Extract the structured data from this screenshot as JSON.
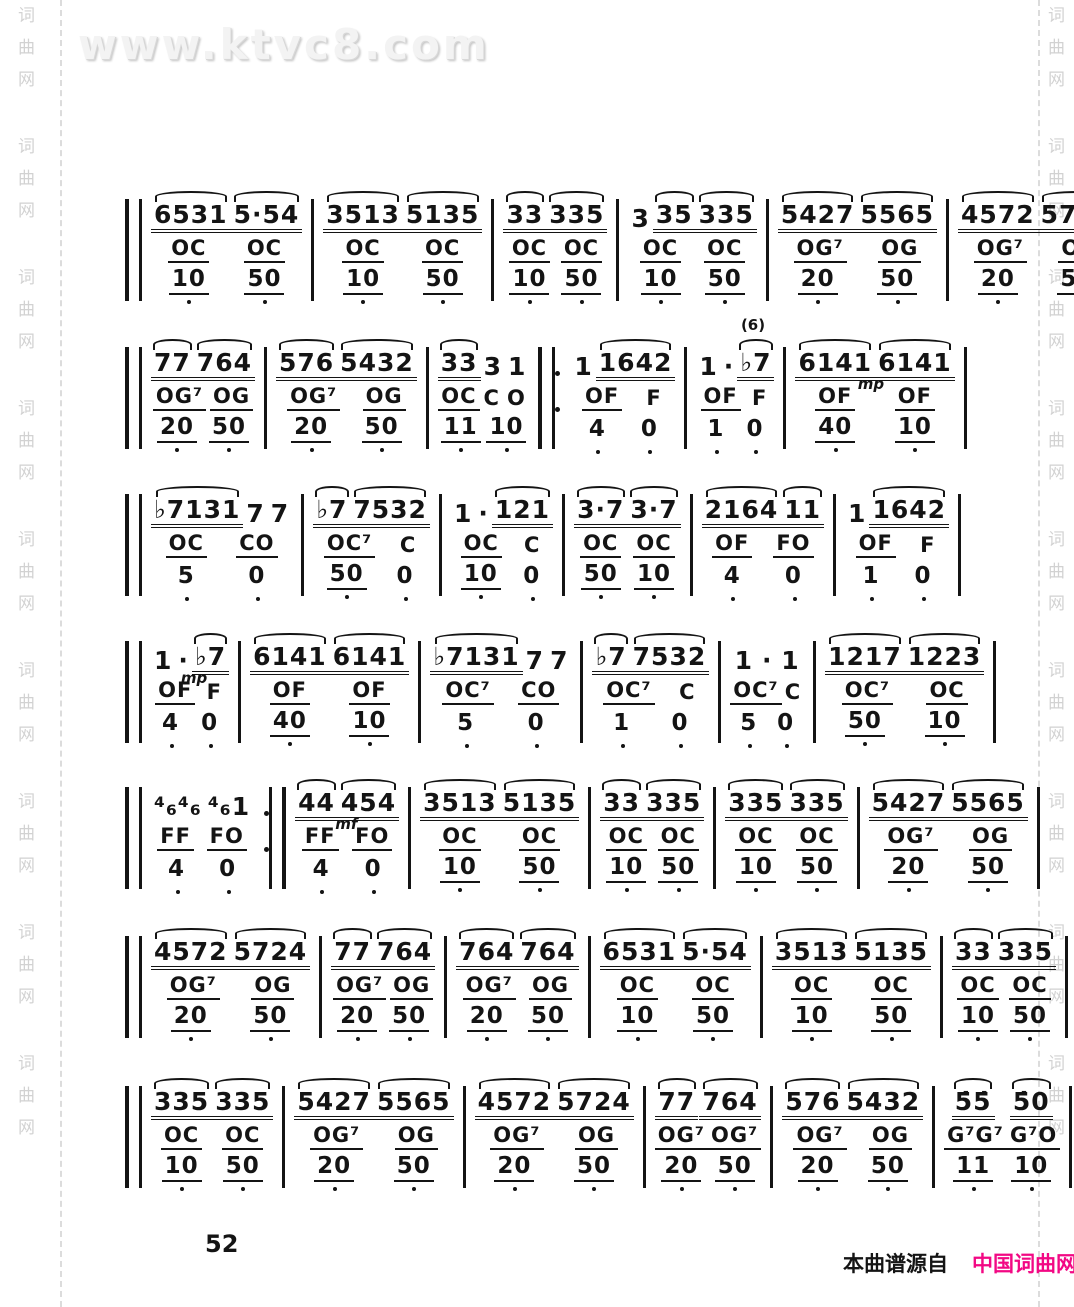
{
  "watermark": {
    "site": "www.ktvc8.com",
    "side_text": "词曲网"
  },
  "page_number": "52",
  "footer": {
    "prefix": "本曲谱源自",
    "site": "中国词曲网",
    "site_color": "#f20884"
  },
  "score": {
    "rows": [
      {
        "start_bar": "double",
        "end_bar": "single",
        "measures": [
          {
            "melody": "6531 5·54",
            "chord": "OC OC",
            "bass": "10 50"
          },
          {
            "melody": "3513 5135",
            "chord": "OC OC",
            "bass": "10 50"
          },
          {
            "melody": "33 335",
            "chord": "OC OC",
            "bass": "10 50"
          },
          {
            "melody": "3 35 335",
            "chord": "OC OC",
            "bass": "10 50"
          },
          {
            "melody": "5427 5565",
            "chord": "OG⁷ OG",
            "bass": "20 50"
          },
          {
            "melody": "4572 5724",
            "chord": "OG⁷ OG",
            "bass": "20 50"
          }
        ]
      },
      {
        "start_bar": "double",
        "end_bar": "single",
        "measures": [
          {
            "melody": "77 764",
            "chord": "OG⁷ OG",
            "bass": "20 50"
          },
          {
            "melody": "576 5432",
            "chord": "OG⁷ OG",
            "bass": "20 50"
          },
          {
            "melody": "33 3 1",
            "chord": "OC C O",
            "bass": "11 10"
          },
          {
            "melody": "1 1642",
            "chord": "OF F",
            "bass": "4 0",
            "left_bar": "repeat-begin"
          },
          {
            "melody": "1 · ♭7",
            "chord": "OF F",
            "bass": "1 0",
            "note": "(6)"
          },
          {
            "melody": "6141 6141",
            "chord": "OF OF",
            "bass": "40 10",
            "note": "mp"
          }
        ]
      },
      {
        "start_bar": "double",
        "end_bar": "single",
        "measures": [
          {
            "melody": "♭7131 7 7",
            "chord": "OC CO",
            "bass": "5 0"
          },
          {
            "melody": "♭7 7532",
            "chord": "OC⁷ C",
            "bass": "50 0"
          },
          {
            "melody": "1 · 121",
            "chord": "OC C",
            "bass": "10 0"
          },
          {
            "melody": "3·7 3·7",
            "chord": "OC OC",
            "bass": "50 10"
          },
          {
            "melody": "2164 11",
            "chord": "OF FO",
            "bass": "4 0"
          },
          {
            "melody": "1 1642",
            "chord": "OF F",
            "bass": "1 0"
          }
        ]
      },
      {
        "start_bar": "double",
        "end_bar": "single",
        "measures": [
          {
            "melody": "1 · ♭7",
            "chord": "OF F",
            "bass": "4 0",
            "note": "mp"
          },
          {
            "melody": "6141 6141",
            "chord": "OF OF",
            "bass": "40 10"
          },
          {
            "melody": "♭7131 7 7",
            "chord": "OC⁷ CO",
            "bass": "5 0"
          },
          {
            "melody": "♭7 7532",
            "chord": "OC⁷ C",
            "bass": "1 0"
          },
          {
            "melody": "1 · 1",
            "chord": "OC⁷ C",
            "bass": "5 0"
          },
          {
            "melody": "1217 1223",
            "chord": "OC⁷ OC",
            "bass": "50 10"
          }
        ]
      },
      {
        "start_bar": "double",
        "end_bar": "single",
        "measures": [
          {
            "melody": "⁴₆⁴₆ ⁴₆1",
            "chord": "FF FO",
            "bass": "4 0"
          },
          {
            "melody": "44 454",
            "chord": "FF FO",
            "bass": "4 0",
            "left_bar": "repeat-end",
            "note": "mf"
          },
          {
            "melody": "3513 5135",
            "chord": "OC OC",
            "bass": "10 50"
          },
          {
            "melody": "33 335",
            "chord": "OC OC",
            "bass": "10 50"
          },
          {
            "melody": "335 335",
            "chord": "OC OC",
            "bass": "10 50"
          },
          {
            "melody": "5427 5565",
            "chord": "OG⁷ OG",
            "bass": "20 50"
          }
        ]
      },
      {
        "start_bar": "double",
        "end_bar": "single",
        "measures": [
          {
            "melody": "4572 5724",
            "chord": "OG⁷ OG",
            "bass": "20 50"
          },
          {
            "melody": "77 764",
            "chord": "OG⁷ OG",
            "bass": "20 50"
          },
          {
            "melody": "764 764",
            "chord": "OG⁷ OG",
            "bass": "20 50"
          },
          {
            "melody": "6531 5·54",
            "chord": "OC OC",
            "bass": "10 50"
          },
          {
            "melody": "3513 5135",
            "chord": "OC OC",
            "bass": "10 50"
          },
          {
            "melody": "33 335",
            "chord": "OC OC",
            "bass": "10 50"
          }
        ]
      },
      {
        "start_bar": "double",
        "end_bar": "final",
        "measures": [
          {
            "melody": "335 335",
            "chord": "OC OC",
            "bass": "10 50"
          },
          {
            "melody": "5427 5565",
            "chord": "OG⁷ OG",
            "bass": "20 50"
          },
          {
            "melody": "4572 5724",
            "chord": "OG⁷ OG",
            "bass": "20 50"
          },
          {
            "melody": "77 764",
            "chord": "OG⁷ OG⁷",
            "bass": "20 50"
          },
          {
            "melody": "576 5432",
            "chord": "OG⁷ OG",
            "bass": "20 50"
          },
          {
            "melody": "5̇5̇ 5̇0",
            "chord": "G⁷G⁷ G⁷O",
            "bass": "11 10"
          }
        ]
      }
    ]
  }
}
